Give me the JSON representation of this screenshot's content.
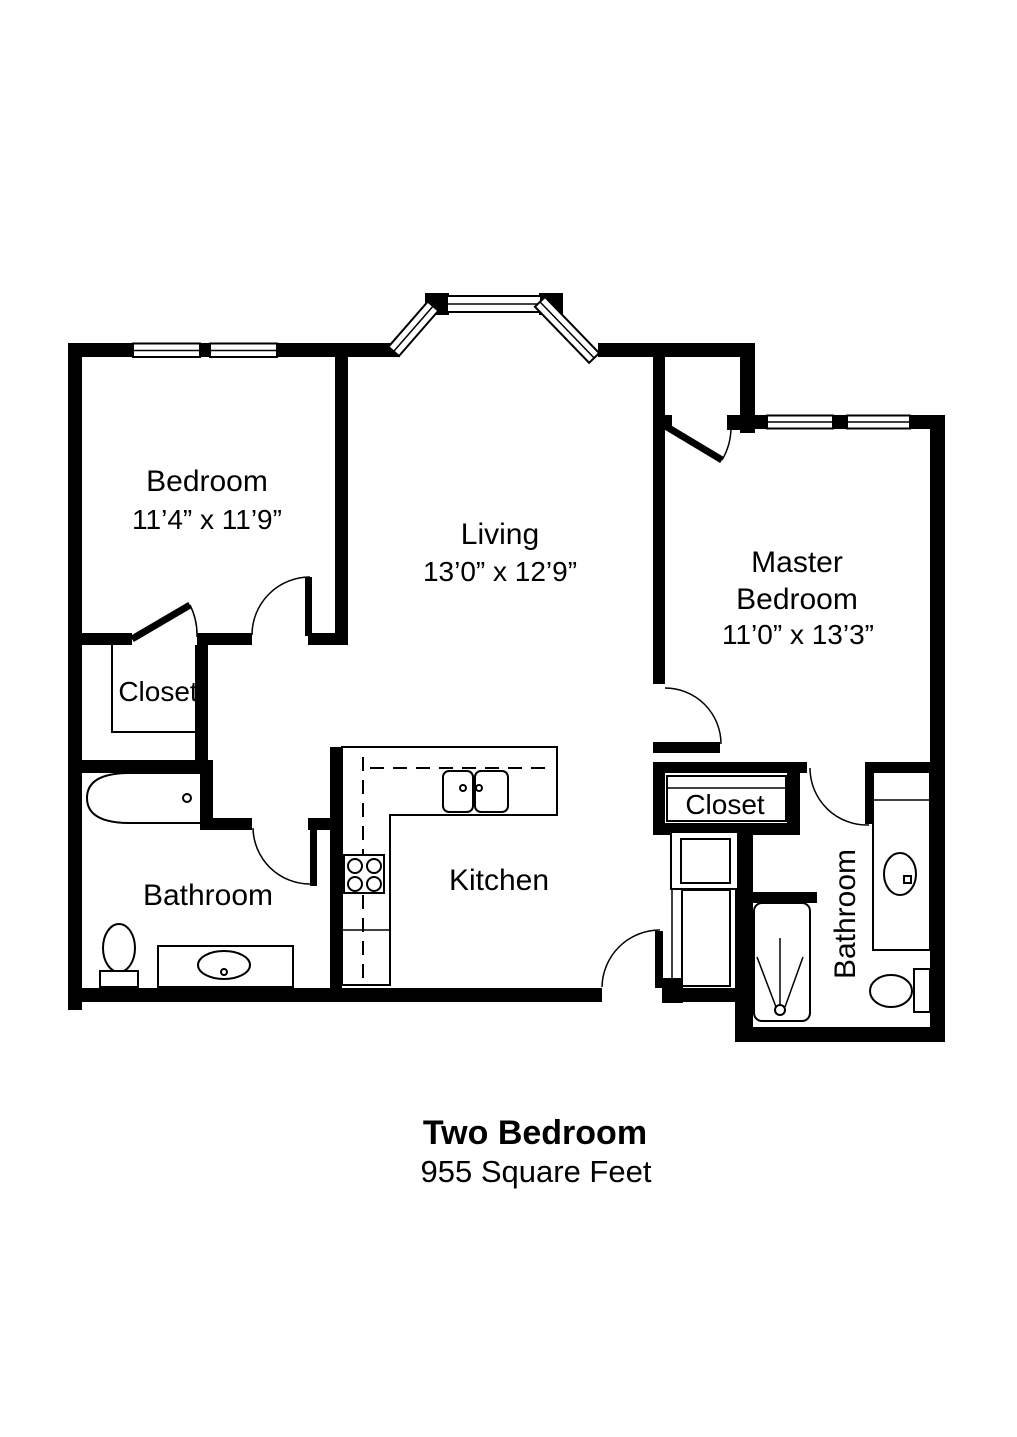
{
  "floor_plan": {
    "title": "Two Bedroom",
    "subtitle": "955 Square Feet",
    "rooms": {
      "bedroom": {
        "label": "Bedroom",
        "dimensions": "11’4” x 11’9”"
      },
      "living": {
        "label": "Living",
        "dimensions": "13’0” x 12’9”"
      },
      "master_bedroom": {
        "label_line1": "Master",
        "label_line2": "Bedroom",
        "dimensions": "11’0” x 13’3”"
      },
      "closet_left": {
        "label": "Closet"
      },
      "closet_right": {
        "label": "Closet"
      },
      "bathroom_left": {
        "label": "Bathroom"
      },
      "bathroom_right": {
        "label": "Bathroom"
      },
      "kitchen": {
        "label": "Kitchen"
      }
    },
    "fixtures": [
      "bathtub-icon",
      "toilet-icon",
      "bathroom-vanity-sink-icon",
      "kitchen-sink-icon",
      "stove-icon",
      "kitchen-counter",
      "washer-icon",
      "utility-appliance-icon",
      "shower-icon",
      "master-vanity-sink-icon",
      "master-toilet-icon"
    ],
    "colors": {
      "wall": "#000000",
      "background": "#ffffff"
    }
  }
}
